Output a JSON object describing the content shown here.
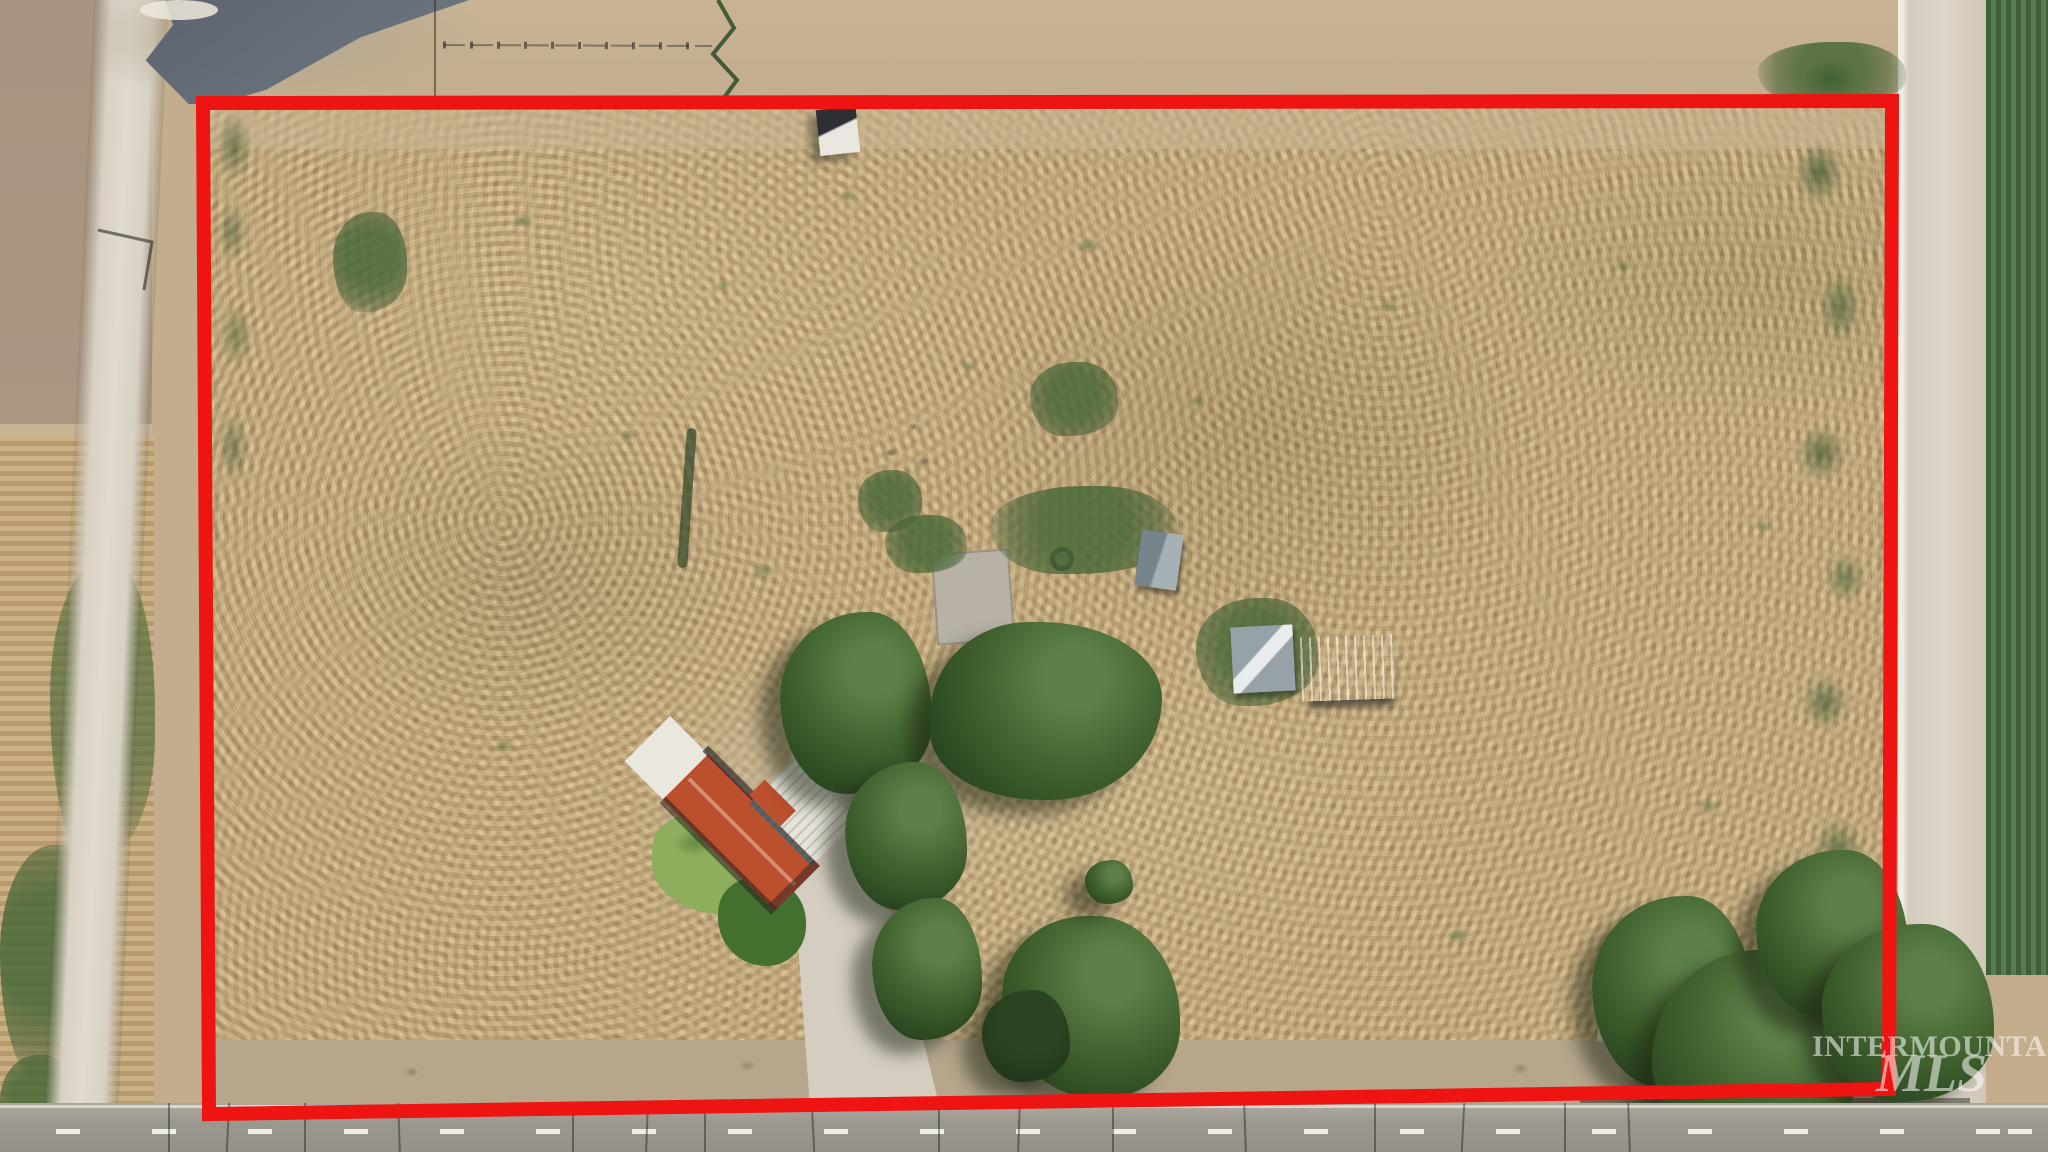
{
  "watermark": {
    "line1": "INTERMOUNTAIN",
    "line2": "MLS"
  },
  "colors": {
    "boundary": "#ee1411",
    "field_gold": "#c3a97b",
    "dirt": "#c3ad8c",
    "asphalt": "#9e9b93",
    "gravel_road": "#d8d1c4",
    "crop_dark": "#3e5f3a",
    "crop_light": "#567c4f",
    "tree": "#35522c",
    "roof_red": "#bb4f2e",
    "roof_white": "#e9e7de",
    "lawn": "#8fae5d",
    "watermark": "rgba(255,255,255,0.55)"
  }
}
